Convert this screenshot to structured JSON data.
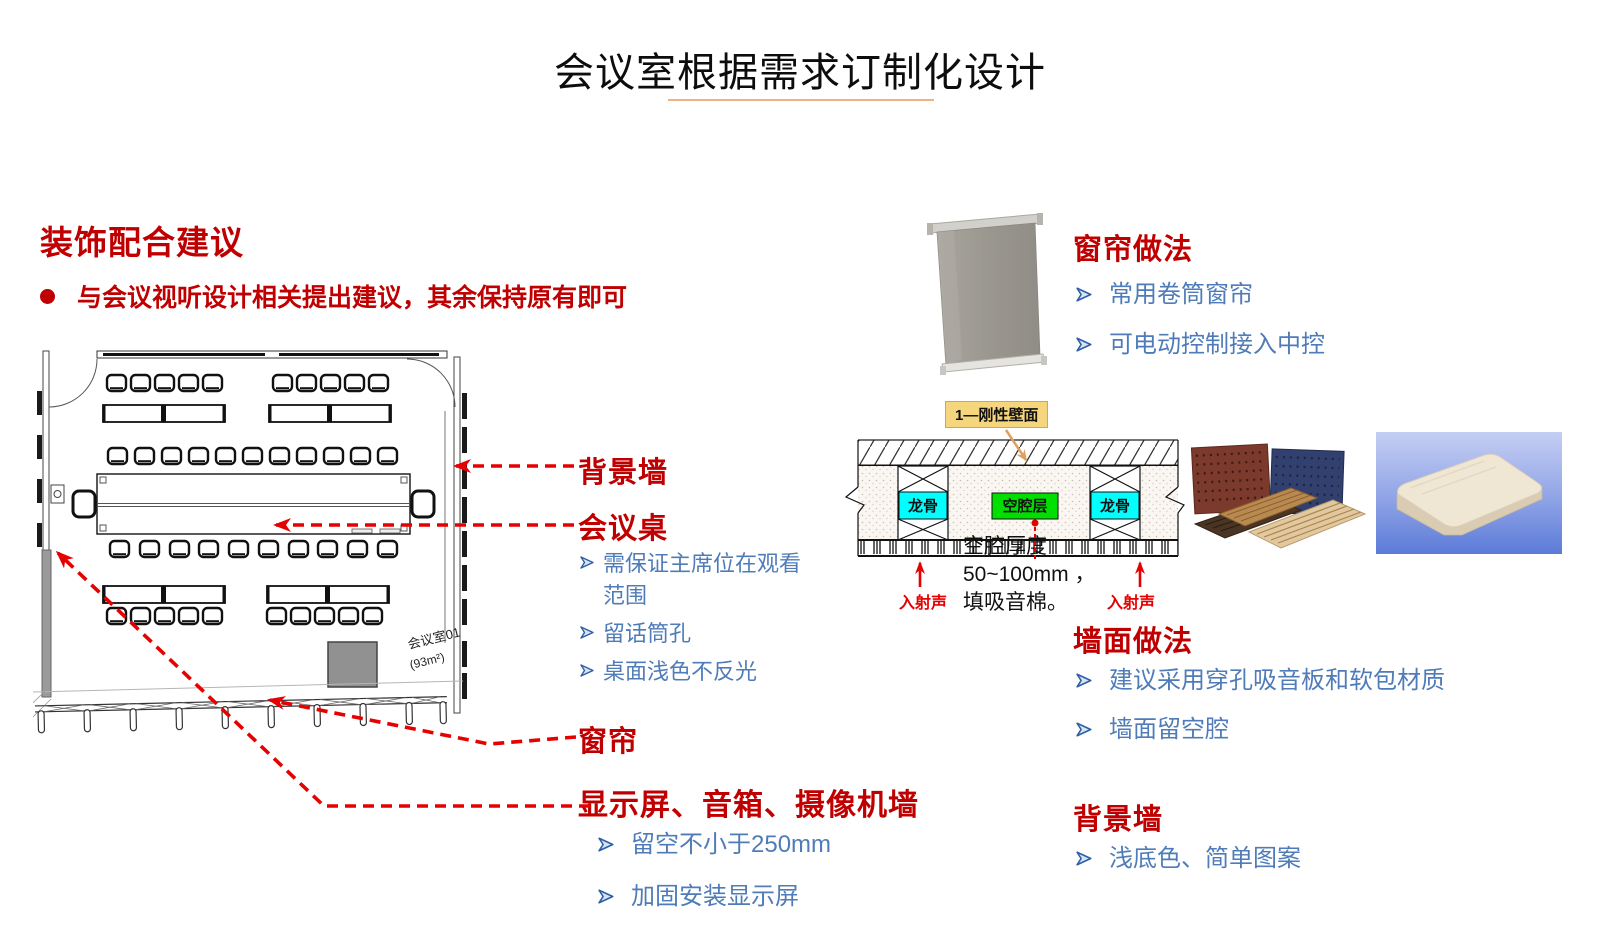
{
  "title": "会议室根据需求订制化设计",
  "left": {
    "heading": "装饰配合建议",
    "bullet": "与会议视听设计相关提出建议，其余保持原有即可"
  },
  "floorplan": {
    "room_label_line1": "会议室01",
    "room_label_line2": "(93m²)"
  },
  "callouts": {
    "bg_wall_label": "背景墙",
    "table": {
      "label": "会议桌",
      "items": [
        "需保证主席位在观看范围",
        "留话筒孔",
        "桌面浅色不反光"
      ]
    },
    "curtain_label": "窗帘",
    "display_wall": {
      "label": "显示屏、音箱、摄像机墙",
      "items": [
        "留空不小于250mm",
        "加固安装显示屏"
      ]
    }
  },
  "curtain_section": {
    "heading": "窗帘做法",
    "items": [
      "常用卷筒窗帘",
      "可电动控制接入中控"
    ]
  },
  "wall_diagram": {
    "rigid_wall_label": "1—刚性壁面",
    "keel_label": "龙骨",
    "cavity_label": "空腔层",
    "incident_sound_label": "入射声",
    "note_line1": "空腔厚度",
    "note_line2": "50~100mm ，",
    "note_line3": "填吸音棉。"
  },
  "wall_section": {
    "heading": "墙面做法",
    "items": [
      "建议采用穿孔吸音板和软包材质",
      "墙面留空腔"
    ]
  },
  "bgwall_section": {
    "heading": "背景墙",
    "items": [
      "浅底色、简单图案"
    ]
  },
  "icons": {
    "bullet_arrow": "➢",
    "bullet_dot": "●"
  },
  "colors": {
    "accent_red": "#C00000",
    "bullet_blue": "#4F7CB8",
    "arrow_red": "#E60000",
    "keel_cyan": "#00FFFF",
    "cavity_green": "#00DF00",
    "label_yellow": "#F6D67C",
    "underline_orange": "#F2B183"
  }
}
